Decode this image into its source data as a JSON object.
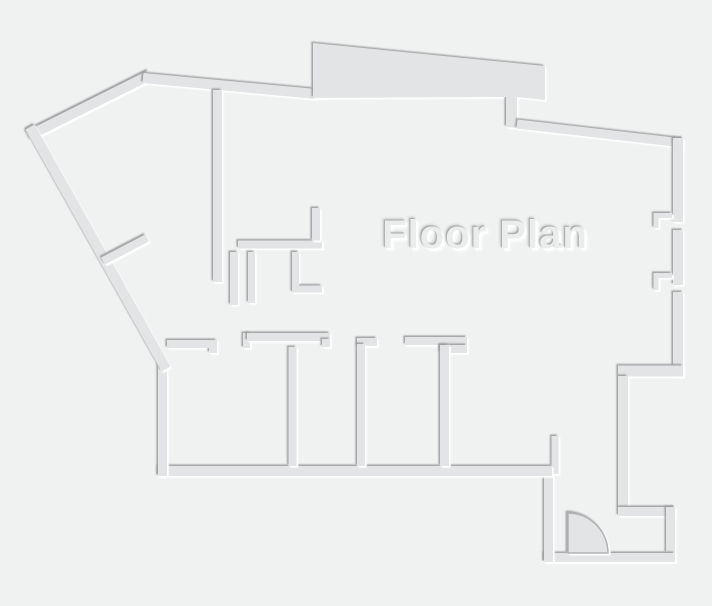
{
  "canvas": {
    "width": 712,
    "height": 606,
    "background": "#f0f1f1"
  },
  "palette": {
    "wall": "#e2e4e5",
    "shadow_dark": "#97999a",
    "shadow_light": "#ffffff",
    "title_fill": "#ebedec",
    "door_arc_stroke": "#b0b2b3"
  },
  "title": {
    "text": "Floor Plan"
  },
  "floorplan": {
    "walls": [
      {
        "name": "nw-diagonal-wall",
        "points": [
          [
            28,
            136
          ],
          [
            150,
            75
          ]
        ],
        "w": 10
      },
      {
        "name": "north-wall-west",
        "points": [
          [
            143,
            78
          ],
          [
            316,
            94
          ]
        ],
        "w": 10
      },
      {
        "name": "balcony-bump",
        "type": "polygon",
        "points": [
          [
            313,
            43
          ],
          [
            545,
            66
          ],
          [
            545,
            100
          ],
          [
            517,
            97
          ],
          [
            517,
            128
          ],
          [
            506,
            127
          ],
          [
            506,
            97
          ],
          [
            313,
            98
          ]
        ]
      },
      {
        "name": "north-wall-east",
        "points": [
          [
            517,
            124
          ],
          [
            683,
            143
          ]
        ],
        "w": 9
      },
      {
        "name": "right-wall-upper",
        "points": [
          [
            678,
            138
          ],
          [
            678,
            222
          ]
        ],
        "w": 10
      },
      {
        "name": "right-wall-middle",
        "points": [
          [
            678,
            230
          ],
          [
            678,
            285
          ]
        ],
        "w": 10
      },
      {
        "name": "right-wall-lower",
        "points": [
          [
            678,
            292
          ],
          [
            678,
            376
          ]
        ],
        "w": 10
      },
      {
        "name": "window-notch-upper",
        "points": [
          [
            672,
            215.5
          ],
          [
            656,
            215.5
          ],
          [
            656,
            228
          ]
        ],
        "w": 5
      },
      {
        "name": "window-notch-lower",
        "points": [
          [
            672,
            275.5
          ],
          [
            656,
            275.5
          ],
          [
            656,
            290
          ]
        ],
        "w": 5
      },
      {
        "name": "east-step-wall",
        "points": [
          [
            618,
            371
          ],
          [
            683,
            371
          ]
        ],
        "w": 11
      },
      {
        "name": "hall-east-wall",
        "points": [
          [
            623,
            376
          ],
          [
            623,
            508
          ]
        ],
        "w": 10
      },
      {
        "name": "entry-jog-wall",
        "points": [
          [
            618,
            511.5
          ],
          [
            675,
            511.5
          ]
        ],
        "w": 9
      },
      {
        "name": "entry-right-wall",
        "points": [
          [
            670.5,
            507
          ],
          [
            670.5,
            553
          ]
        ],
        "w": 9
      },
      {
        "name": "entry-bottom-wall",
        "points": [
          [
            544,
            557.5
          ],
          [
            675,
            557.5
          ]
        ],
        "w": 9
      },
      {
        "name": "entry-left-wall",
        "points": [
          [
            548.5,
            472
          ],
          [
            548.5,
            562
          ]
        ],
        "w": 9
      },
      {
        "name": "entry-stub-wall",
        "points": [
          [
            555,
            436
          ],
          [
            555,
            474
          ]
        ],
        "w": 7
      },
      {
        "name": "south-wall",
        "points": [
          [
            158,
            471
          ],
          [
            552,
            471
          ]
        ],
        "w": 10
      },
      {
        "name": "rooms-left-wall",
        "points": [
          [
            162.5,
            364
          ],
          [
            162.5,
            476
          ]
        ],
        "w": 9
      },
      {
        "name": "sw-diagonal-wall",
        "points": [
          [
            30,
            127
          ],
          [
            166,
            369
          ]
        ],
        "w": 10
      },
      {
        "name": "diagonal-door-stub",
        "points": [
          [
            103,
            261
          ],
          [
            147,
            238
          ]
        ],
        "w": 8
      },
      {
        "name": "studio-wall",
        "points": [
          [
            217.5,
            90
          ],
          [
            217.5,
            282
          ]
        ],
        "w": 9
      },
      {
        "name": "kitchen-wall-horizontal",
        "points": [
          [
            238,
            244.5
          ],
          [
            322,
            244.5
          ]
        ],
        "w": 8
      },
      {
        "name": "kitchen-stub-up",
        "points": [
          [
            316,
            208
          ],
          [
            316,
            240.5
          ]
        ],
        "w": 8
      },
      {
        "name": "closet-wall-1",
        "points": [
          [
            234,
            252
          ],
          [
            234,
            305
          ]
        ],
        "w": 8
      },
      {
        "name": "closet-wall-2",
        "points": [
          [
            251.5,
            252
          ],
          [
            251.5,
            303
          ]
        ],
        "w": 7
      },
      {
        "name": "closet-wall-3",
        "points": [
          [
            295.5,
            252
          ],
          [
            295.5,
            289
          ],
          [
            322,
            289
          ]
        ],
        "w": 7
      },
      {
        "name": "room1-top-wall",
        "points": [
          [
            167,
            344
          ],
          [
            213,
            344
          ],
          [
            213,
            353
          ]
        ],
        "w": 8
      },
      {
        "name": "room2-step-wall",
        "points": [
          [
            246.5,
            348
          ],
          [
            246.5,
            333
          ]
        ],
        "w": 7
      },
      {
        "name": "room2-top-wall",
        "points": [
          [
            247,
            337
          ],
          [
            330,
            337
          ]
        ],
        "w": 8
      },
      {
        "name": "room2-end-tab",
        "points": [
          [
            326,
            339
          ],
          [
            326,
            347
          ]
        ],
        "w": 8
      },
      {
        "name": "divider-wall-1",
        "points": [
          [
            292.5,
            347
          ],
          [
            292.5,
            466
          ]
        ],
        "w": 8
      },
      {
        "name": "divider-cap",
        "points": [
          [
            357,
            342
          ],
          [
            377,
            342
          ]
        ],
        "w": 8
      },
      {
        "name": "divider-wall-2",
        "points": [
          [
            361,
            344
          ],
          [
            361,
            466
          ]
        ],
        "w": 8
      },
      {
        "name": "t-wall-horizontal",
        "points": [
          [
            405,
            341
          ],
          [
            467,
            341
          ]
        ],
        "w": 8
      },
      {
        "name": "t-wall-pad",
        "points": [
          [
            440,
            349
          ],
          [
            467,
            349
          ]
        ],
        "w": 8
      },
      {
        "name": "divider-wall-3",
        "points": [
          [
            444.5,
            345
          ],
          [
            444.5,
            466
          ]
        ],
        "w": 9
      }
    ],
    "door": {
      "hinge": [
        568,
        553
      ],
      "radius": 40
    }
  }
}
